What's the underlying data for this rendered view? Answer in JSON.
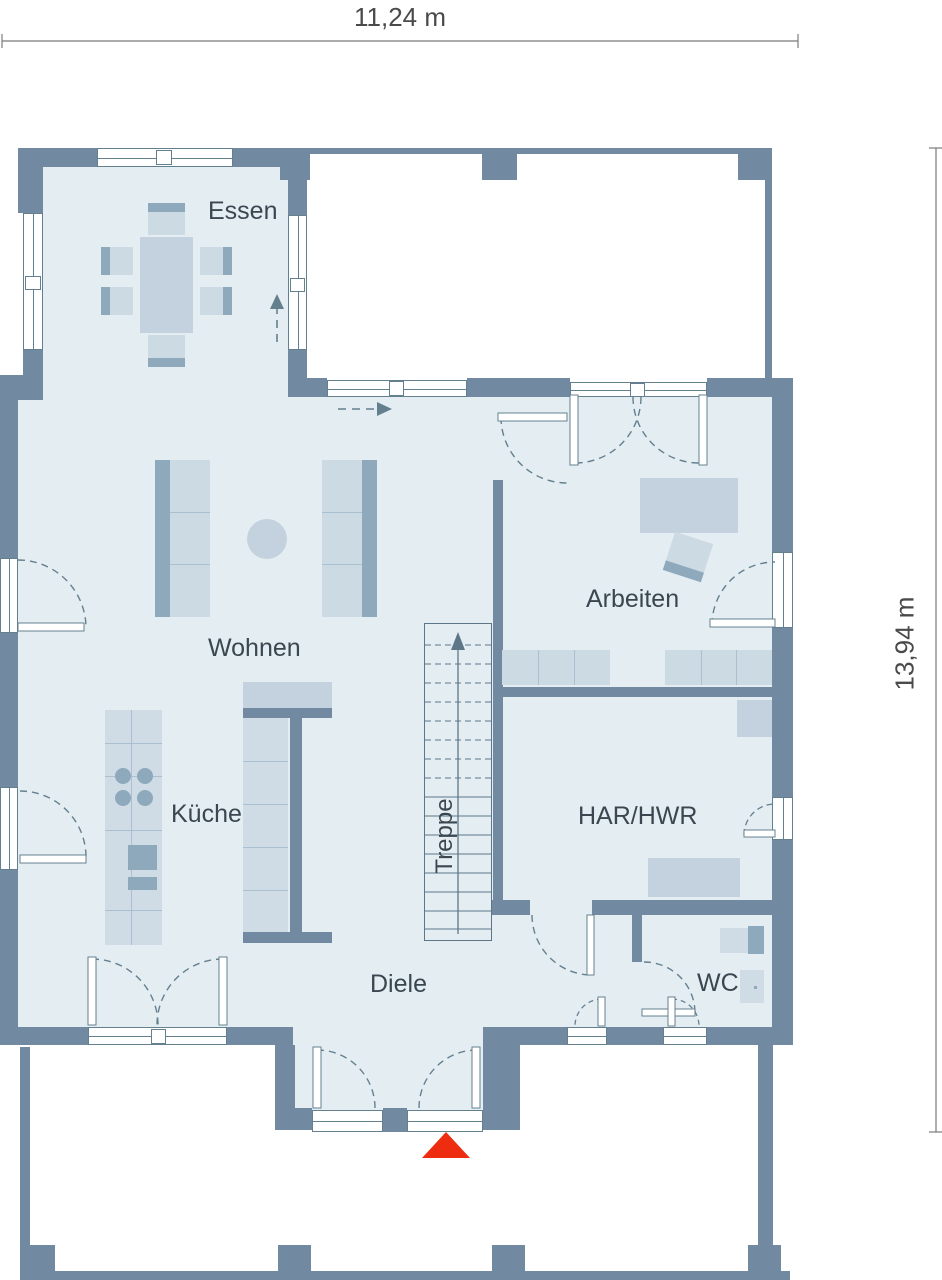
{
  "plan_title": "Erdgeschoss Grundriss",
  "dimensions": {
    "width_label": "11,24 m",
    "height_label": "13,94 m"
  },
  "rooms": {
    "essen": "Essen",
    "wohnen": "Wohnen",
    "kueche": "Küche",
    "arbeiten": "Arbeiten",
    "har_hwr": "HAR/HWR",
    "wc": "WC",
    "diele": "Diele",
    "treppe": "Treppe"
  },
  "markers": {
    "entrance_icon": "red-triangle-entrance-marker",
    "stairs_direction": "up",
    "circulation_arrows": [
      "essen-up-arrow",
      "wohnen-right-arrow"
    ]
  },
  "colors": {
    "wall": "#7189a1",
    "floor": "#e4edf2",
    "furniture": "#ccdae3",
    "furniture_dark": "#8ea9bc",
    "line": "#64808f",
    "accent_red": "#ee2c10",
    "label_text": "#3a4750",
    "dimension_text": "#4a4a4a"
  }
}
